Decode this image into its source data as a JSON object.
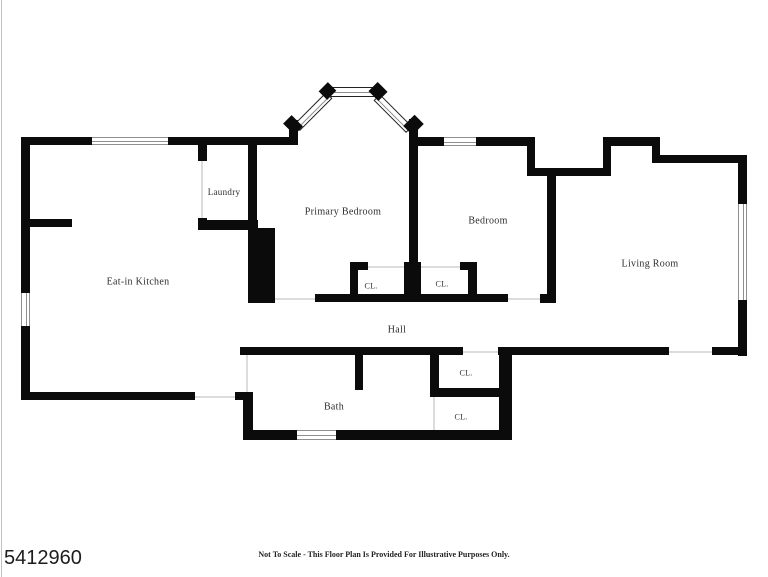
{
  "page": {
    "listing_id": "5412960",
    "disclaimer": "Not To Scale - This Floor Plan Is Provided For Illustrative Purposes Only."
  },
  "floorplan": {
    "canvas": {
      "width": 768,
      "height": 577
    },
    "colors": {
      "wall": "#0b0b0b",
      "window_line": "#8f8f8f",
      "window_frame": "#222222",
      "door_line": "#dcdcdc",
      "label": "#2e2e2e",
      "edge_line": "#c2c2c2"
    },
    "rooms": [
      {
        "label": "Eat-in Kitchen",
        "cx": 138,
        "cy": 282,
        "fs": 10
      },
      {
        "label": "Laundry",
        "cx": 224,
        "cy": 192,
        "fs": 9
      },
      {
        "label": "Primary Bedroom",
        "cx": 343,
        "cy": 212,
        "fs": 10
      },
      {
        "label": "Bedroom",
        "cx": 488,
        "cy": 221,
        "fs": 10
      },
      {
        "label": "Living Room",
        "cx": 650,
        "cy": 264,
        "fs": 10
      },
      {
        "label": "Hall",
        "cx": 397,
        "cy": 330,
        "fs": 10
      },
      {
        "label": "Bath",
        "cx": 334,
        "cy": 407,
        "fs": 10
      },
      {
        "label": "CL.",
        "cx": 371,
        "cy": 286,
        "fs": 8
      },
      {
        "label": "CL.",
        "cx": 442,
        "cy": 284,
        "fs": 8
      },
      {
        "label": "CL.",
        "cx": 466,
        "cy": 373,
        "fs": 8
      },
      {
        "label": "CL.",
        "cx": 461,
        "cy": 417,
        "fs": 8
      }
    ],
    "walls": [
      [
        21,
        137,
        72,
        8
      ],
      [
        168,
        137,
        40,
        8
      ],
      [
        21,
        137,
        9,
        161
      ],
      [
        21,
        327,
        9,
        73
      ],
      [
        21,
        219,
        51,
        8
      ],
      [
        21,
        392,
        174,
        8
      ],
      [
        235,
        392,
        18,
        8
      ],
      [
        198,
        145,
        9,
        16
      ],
      [
        198,
        218,
        9,
        12
      ],
      [
        198,
        220,
        60,
        10
      ],
      [
        248,
        145,
        9,
        84
      ],
      [
        207,
        137,
        84,
        8
      ],
      [
        248,
        228,
        27,
        75
      ],
      [
        289,
        120,
        9,
        25
      ],
      [
        409,
        119,
        9,
        27
      ],
      [
        409,
        125,
        9,
        177
      ],
      [
        404,
        262,
        17,
        40
      ],
      [
        418,
        137,
        22,
        9
      ],
      [
        480,
        137,
        47,
        9
      ],
      [
        527,
        137,
        8,
        39
      ],
      [
        527,
        168,
        84,
        8
      ],
      [
        603,
        137,
        8,
        39
      ],
      [
        603,
        137,
        57,
        9
      ],
      [
        652,
        137,
        8,
        26
      ],
      [
        652,
        155,
        95,
        8
      ],
      [
        738,
        155,
        9,
        47
      ],
      [
        738,
        302,
        9,
        54
      ],
      [
        547,
        176,
        9,
        127
      ],
      [
        540,
        294,
        16,
        9
      ],
      [
        315,
        294,
        193,
        8
      ],
      [
        350,
        262,
        8,
        40
      ],
      [
        350,
        262,
        18,
        8
      ],
      [
        460,
        262,
        17,
        8
      ],
      [
        468,
        262,
        9,
        40
      ],
      [
        240,
        347,
        223,
        8
      ],
      [
        498,
        347,
        171,
        8
      ],
      [
        712,
        347,
        35,
        8
      ],
      [
        243,
        392,
        10,
        48
      ],
      [
        355,
        355,
        8,
        35
      ],
      [
        430,
        347,
        9,
        45
      ],
      [
        430,
        388,
        75,
        9
      ],
      [
        499,
        347,
        13,
        93
      ],
      [
        430,
        430,
        10,
        10
      ],
      [
        243,
        430,
        50,
        10
      ],
      [
        340,
        430,
        172,
        10
      ]
    ],
    "windows": [
      {
        "x": 92,
        "y": 137,
        "w": 76,
        "h": 8,
        "orient": "h",
        "style": "plain"
      },
      {
        "x": 21,
        "y": 289,
        "w": 9,
        "h": 41,
        "orient": "v",
        "style": "caps"
      },
      {
        "x": 440,
        "y": 137,
        "w": 40,
        "h": 9,
        "orient": "h",
        "style": "caps"
      },
      {
        "x": 738,
        "y": 200,
        "w": 9,
        "h": 104,
        "orient": "v",
        "style": "caps"
      },
      {
        "x": 293,
        "y": 430,
        "w": 47,
        "h": 10,
        "orient": "h",
        "style": "caps"
      },
      {
        "x": 328,
        "y": 87,
        "w": 47,
        "h": 10,
        "orient": "h",
        "style": "boxed"
      }
    ],
    "diagonal_windows": [
      {
        "cx": 313,
        "cy": 111,
        "len": 46,
        "thick": 9,
        "angle": -45
      },
      {
        "cx": 393,
        "cy": 113,
        "len": 46,
        "thick": 9,
        "angle": 45
      }
    ],
    "posts": [
      {
        "x": 321,
        "y": 85,
        "w": 13,
        "h": 12,
        "rot": -45
      },
      {
        "x": 371,
        "y": 85,
        "w": 14,
        "h": 13,
        "rot": 45
      },
      {
        "x": 287,
        "y": 117,
        "w": 12,
        "h": 16,
        "rot": -45
      },
      {
        "x": 407,
        "y": 117,
        "w": 13,
        "h": 16,
        "rot": 45
      }
    ],
    "door_gaps": [
      [
        275,
        298,
        40,
        2
      ],
      [
        508,
        298,
        32,
        2
      ],
      [
        368,
        266,
        37,
        2
      ],
      [
        421,
        266,
        39,
        2
      ],
      [
        463,
        351,
        35,
        2
      ],
      [
        669,
        351,
        43,
        2
      ],
      [
        195,
        396,
        40,
        2
      ],
      [
        201,
        161,
        2,
        57
      ],
      [
        246,
        355,
        2,
        37
      ],
      [
        433,
        397,
        2,
        33
      ]
    ]
  }
}
